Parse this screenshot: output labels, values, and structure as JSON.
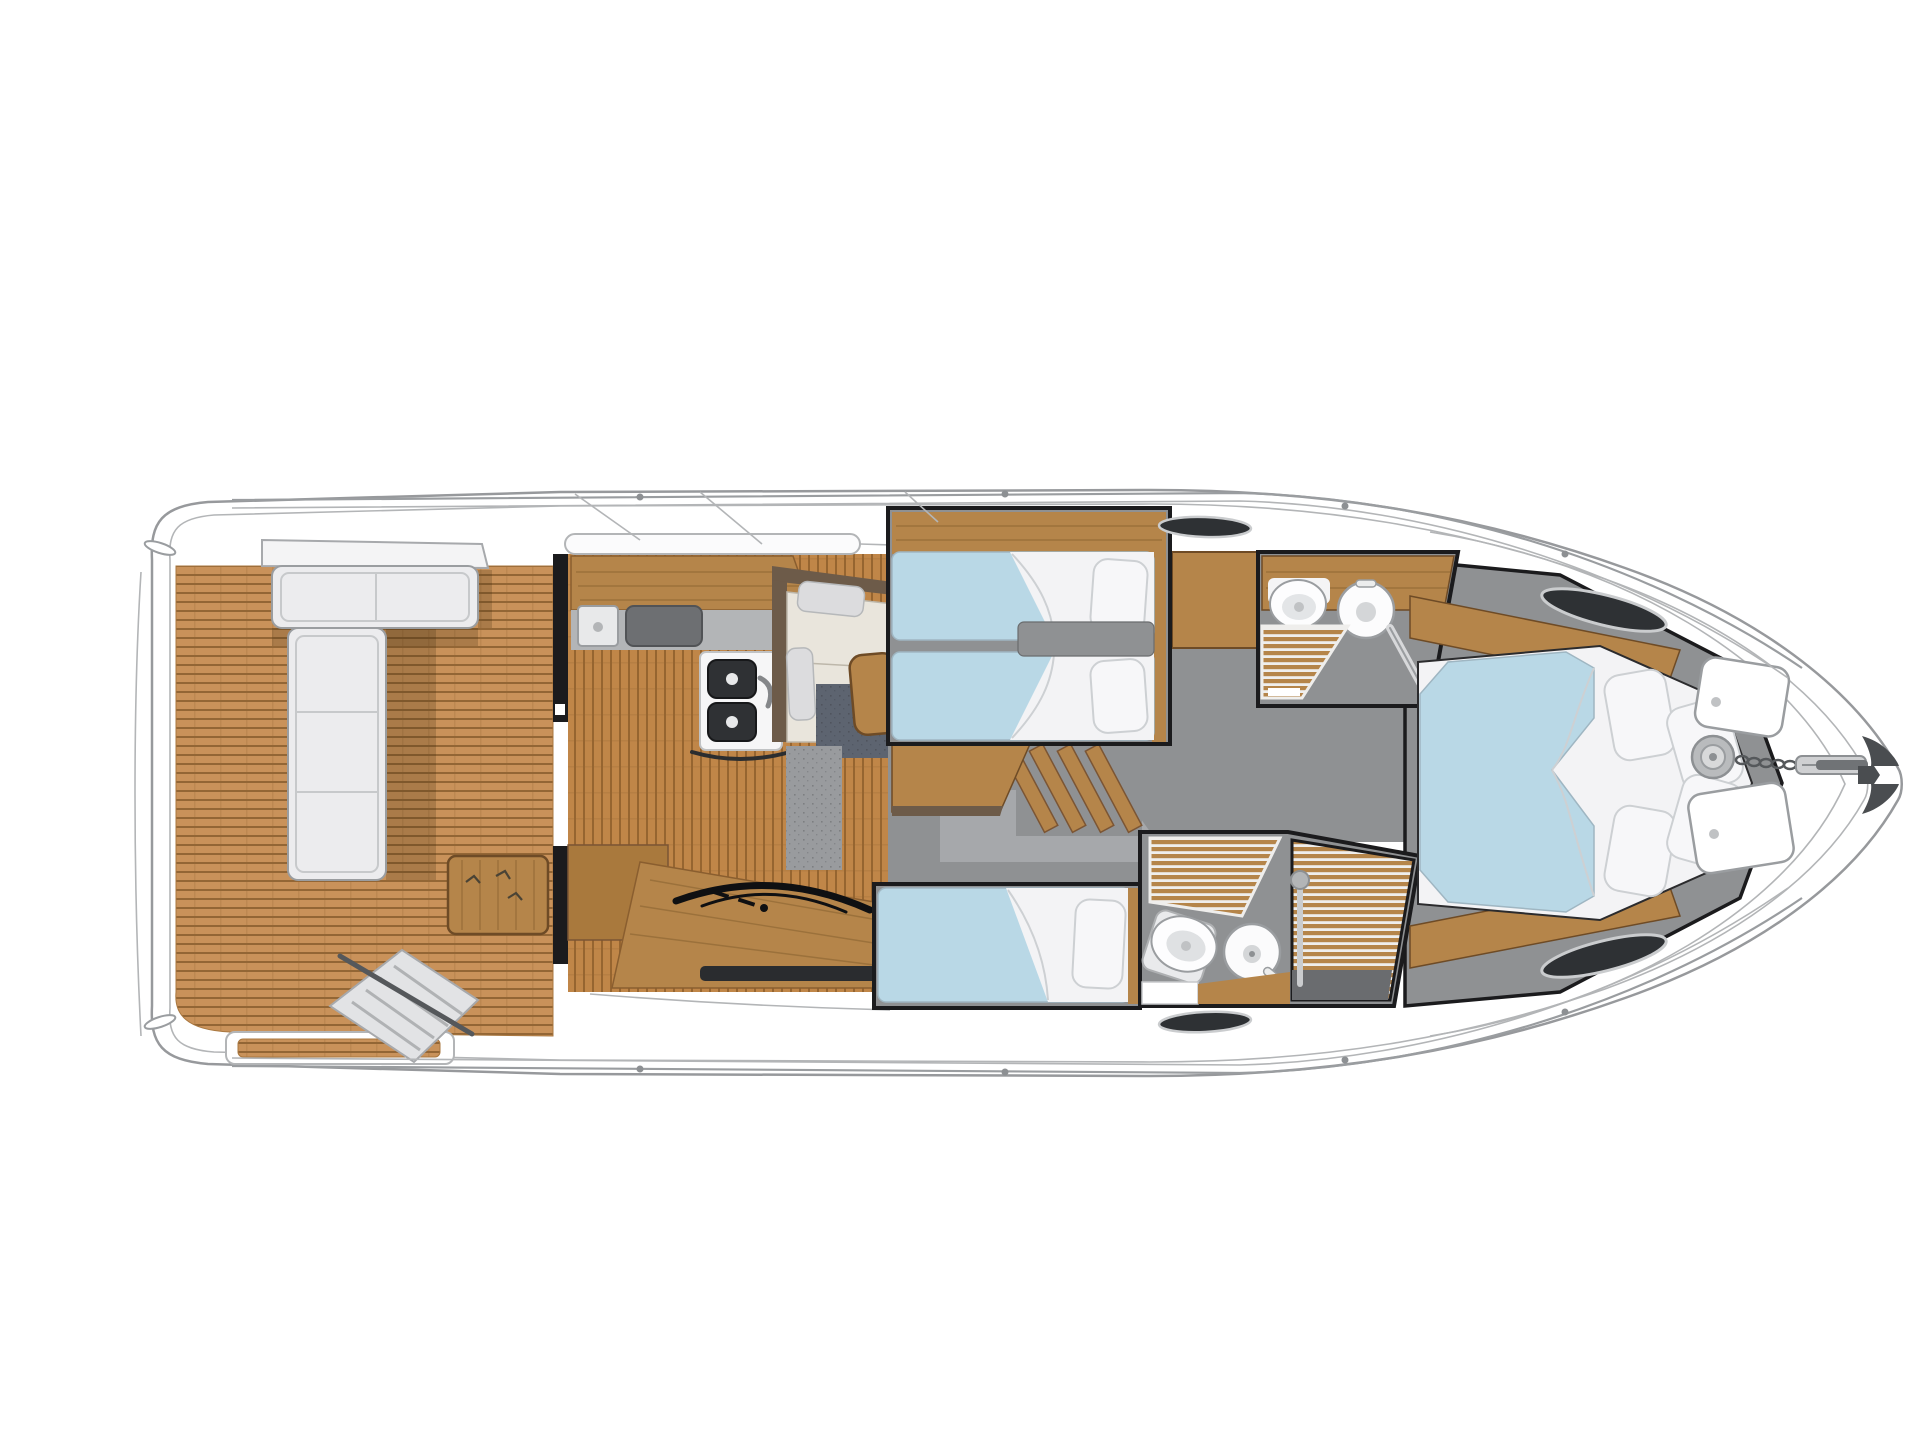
{
  "meta": {
    "kind": "yacht-deck-plan",
    "description": "Top-down interior deck plan of a motor yacht, bow oriented to the right, no visible text in the drawing"
  },
  "palette": {
    "background": "#ffffff",
    "hull_fill": "#ffffff",
    "hull_line": "#97999c",
    "hull_line_light": "#bbbdc0",
    "outline_dark": "#1b1b1d",
    "teak_base": "#c9925a",
    "teak_groove": "#8a5e2f",
    "floor_wood_base": "#c08648",
    "floor_wood_groove": "#8c5c2b",
    "cabinet_wood": "#b5854a",
    "cabinet_wood_dark": "#6e4b26",
    "trim_wood_dark": "#6d5b49",
    "counter_gray": "#b3b5b7",
    "floor_gray": "#8f9193",
    "floor_gray_light": "#a6a8ab",
    "carpet_navy": "#5d6470",
    "carpet_gray": "#999b9e",
    "bed_blue": "#b9d8e6",
    "linen_white": "#f3f3f5",
    "linen_shadow": "#cdd0d3",
    "cushion_cream": "#e9e5dc",
    "seat_white": "#ececee",
    "steel_dark": "#2f3134",
    "steel_mid": "#6d6f72",
    "chrome": "#caccce",
    "window_black": "#2e3134",
    "grate_gap": "#efeeec",
    "shadow": "rgba(60,40,15,0.22)"
  },
  "rooms": {
    "aft_deck": "aft-deck-cockpit",
    "salon": "salon-galley-helm",
    "twin_cabin": "twin-berth-cabin",
    "guest_cabin": "guest-cabin",
    "day_head": "lower-bathroom-shower",
    "master_head": "upper-bathroom",
    "owner_cabin": "owner-cabin-bow",
    "foredeck": "foredeck-anchor"
  },
  "fixtures": [
    "l-shaped-cockpit-bench",
    "cockpit-table",
    "flybridge-stairs",
    "galley-counter",
    "cooktop",
    "galley-sink",
    "double-sink",
    "dinette-table",
    "helm-wheel",
    "companionway-stairs",
    "twin-berths",
    "guest-berth",
    "owner-berth",
    "toilet",
    "round-washbasin",
    "teak-shower-grate",
    "deck-hatch",
    "windlass",
    "anchor-chain",
    "anchor",
    "hull-window"
  ]
}
